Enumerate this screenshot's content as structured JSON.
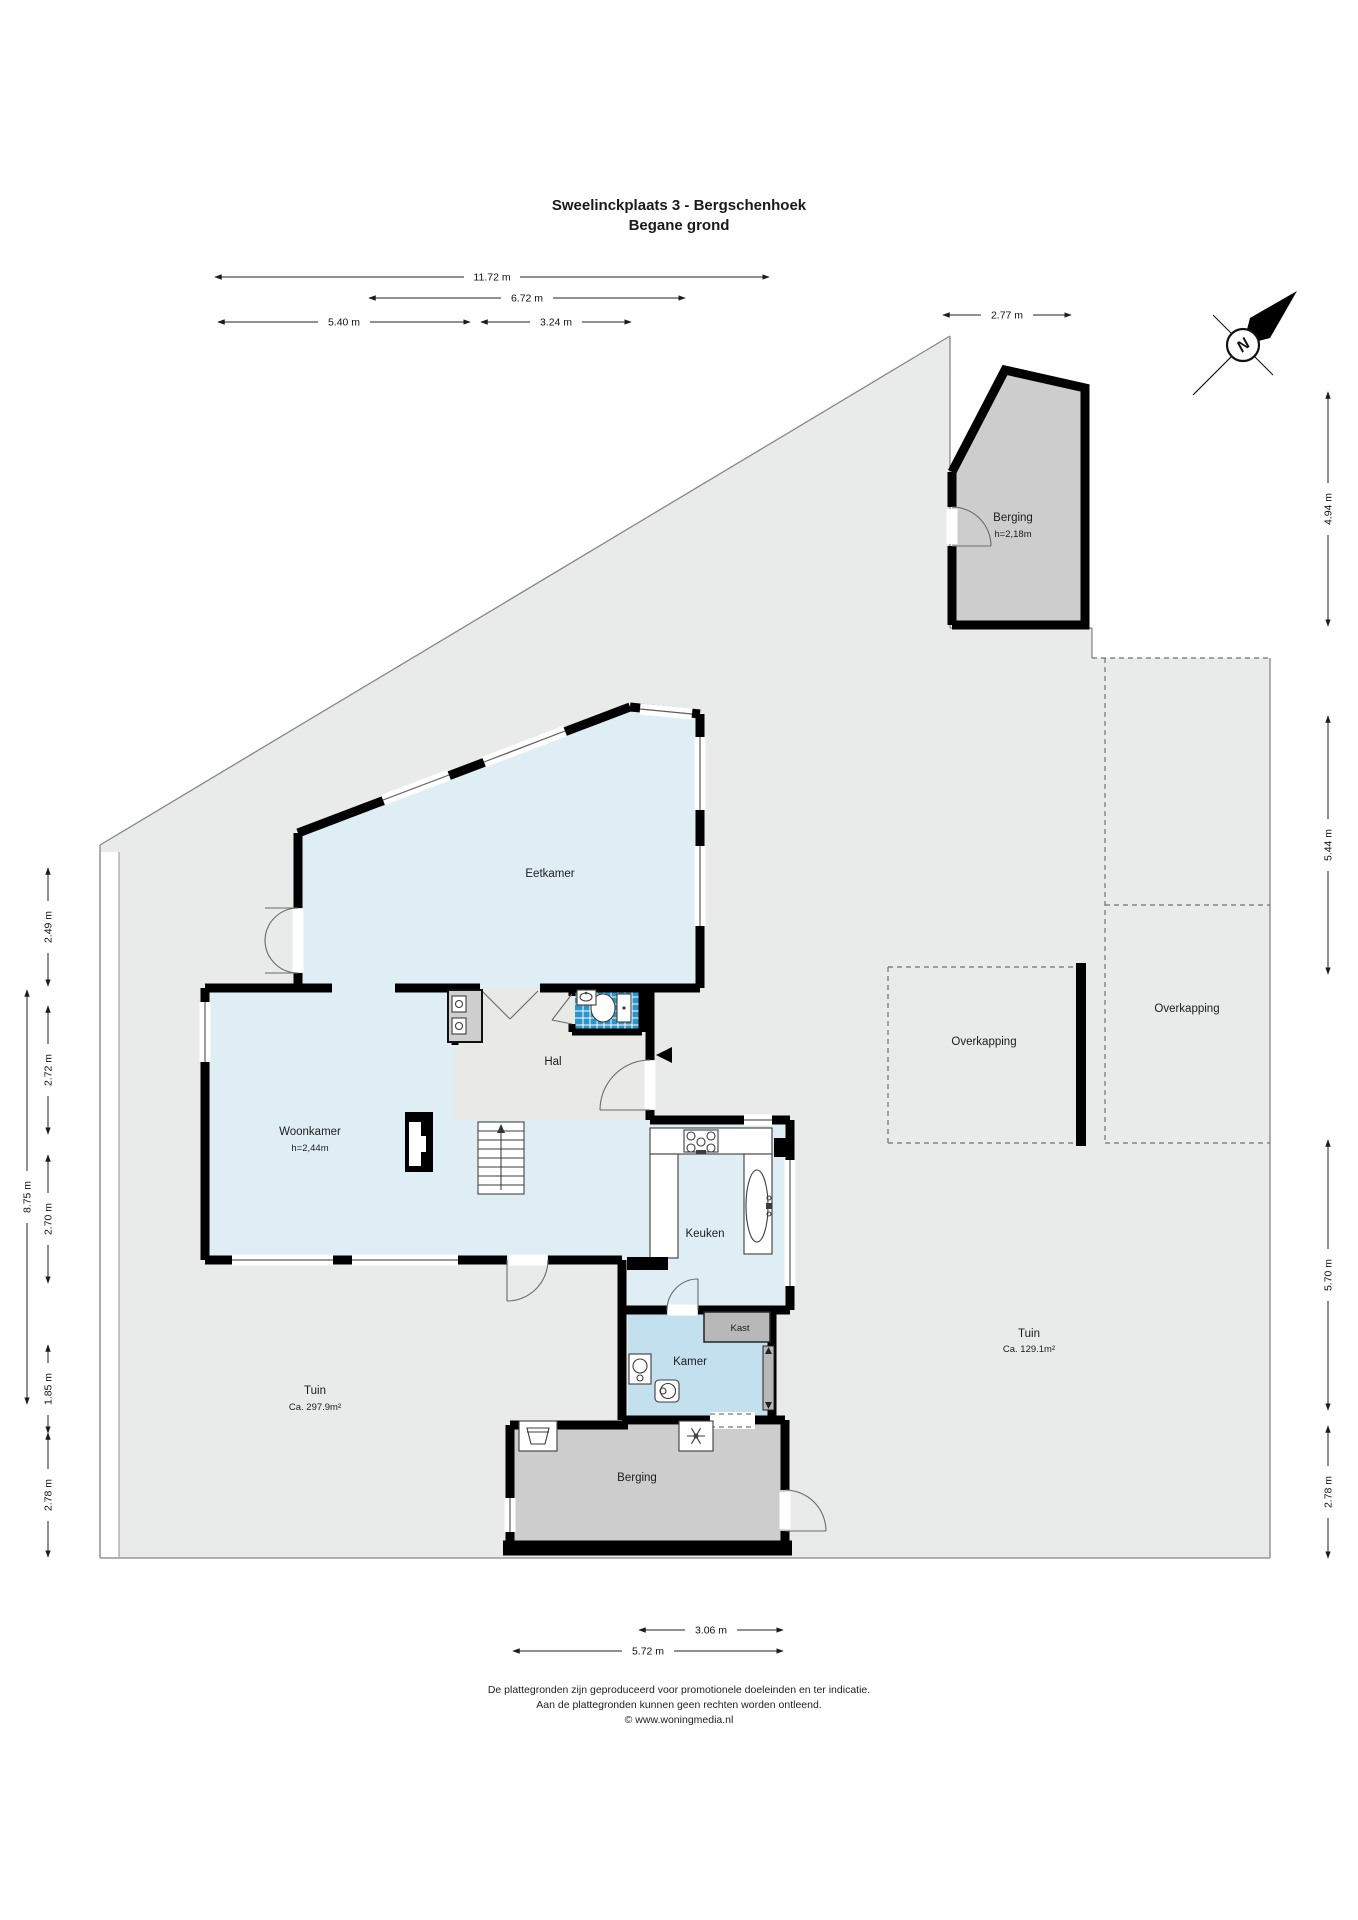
{
  "title": {
    "line1": "Sweelinckplaats 3 - Bergschenhoek",
    "line2": "Begane grond"
  },
  "compass": {
    "north": "N"
  },
  "rooms": {
    "berging_top": {
      "name": "Berging",
      "ceiling": "h=2,18m"
    },
    "eetkamer": {
      "name": "Eetkamer"
    },
    "hal": {
      "name": "Hal"
    },
    "woonkamer": {
      "name": "Woonkamer",
      "ceiling": "h=2,44m"
    },
    "keuken": {
      "name": "Keuken"
    },
    "kamer": {
      "name": "Kamer"
    },
    "kast": {
      "name": "Kast"
    },
    "berging_bottom": {
      "name": "Berging"
    },
    "overkapping_left": {
      "name": "Overkapping"
    },
    "overkapping_right": {
      "name": "Overkapping"
    },
    "tuin_left": {
      "name": "Tuin",
      "area": "Ca. 297.9m²"
    },
    "tuin_right": {
      "name": "Tuin",
      "area": "Ca. 129.1m²"
    }
  },
  "dimensions": {
    "top": [
      "11.72 m",
      "6.72 m",
      "5.40 m",
      "3.24 m",
      "2.77 m"
    ],
    "left": [
      "2.49 m",
      "2.72 m",
      "2.70 m",
      "1.85 m",
      "2.78 m",
      "8.75 m"
    ],
    "right": [
      "4.94 m",
      "5.44 m",
      "5.70 m",
      "2.78 m"
    ],
    "bottom": [
      "3.06 m",
      "5.72 m"
    ]
  },
  "footer": {
    "line1": "De plattegronden zijn geproduceerd voor promotionele doeleinden en ter indicatie.",
    "line2": "Aan de plattegronden kunnen geen rechten worden ontleend.",
    "line3": "© www.woningmedia.nl"
  },
  "colors": {
    "plot_gray": "#e9eaea",
    "room_light_blue": "#dfeef5",
    "kamer_blue": "#c2e0ed",
    "tile_blue": "#2e95ca",
    "berging_gray": "#cdcdcd",
    "hal_gray": "#e9e9e6",
    "wall_black": "#000000"
  }
}
